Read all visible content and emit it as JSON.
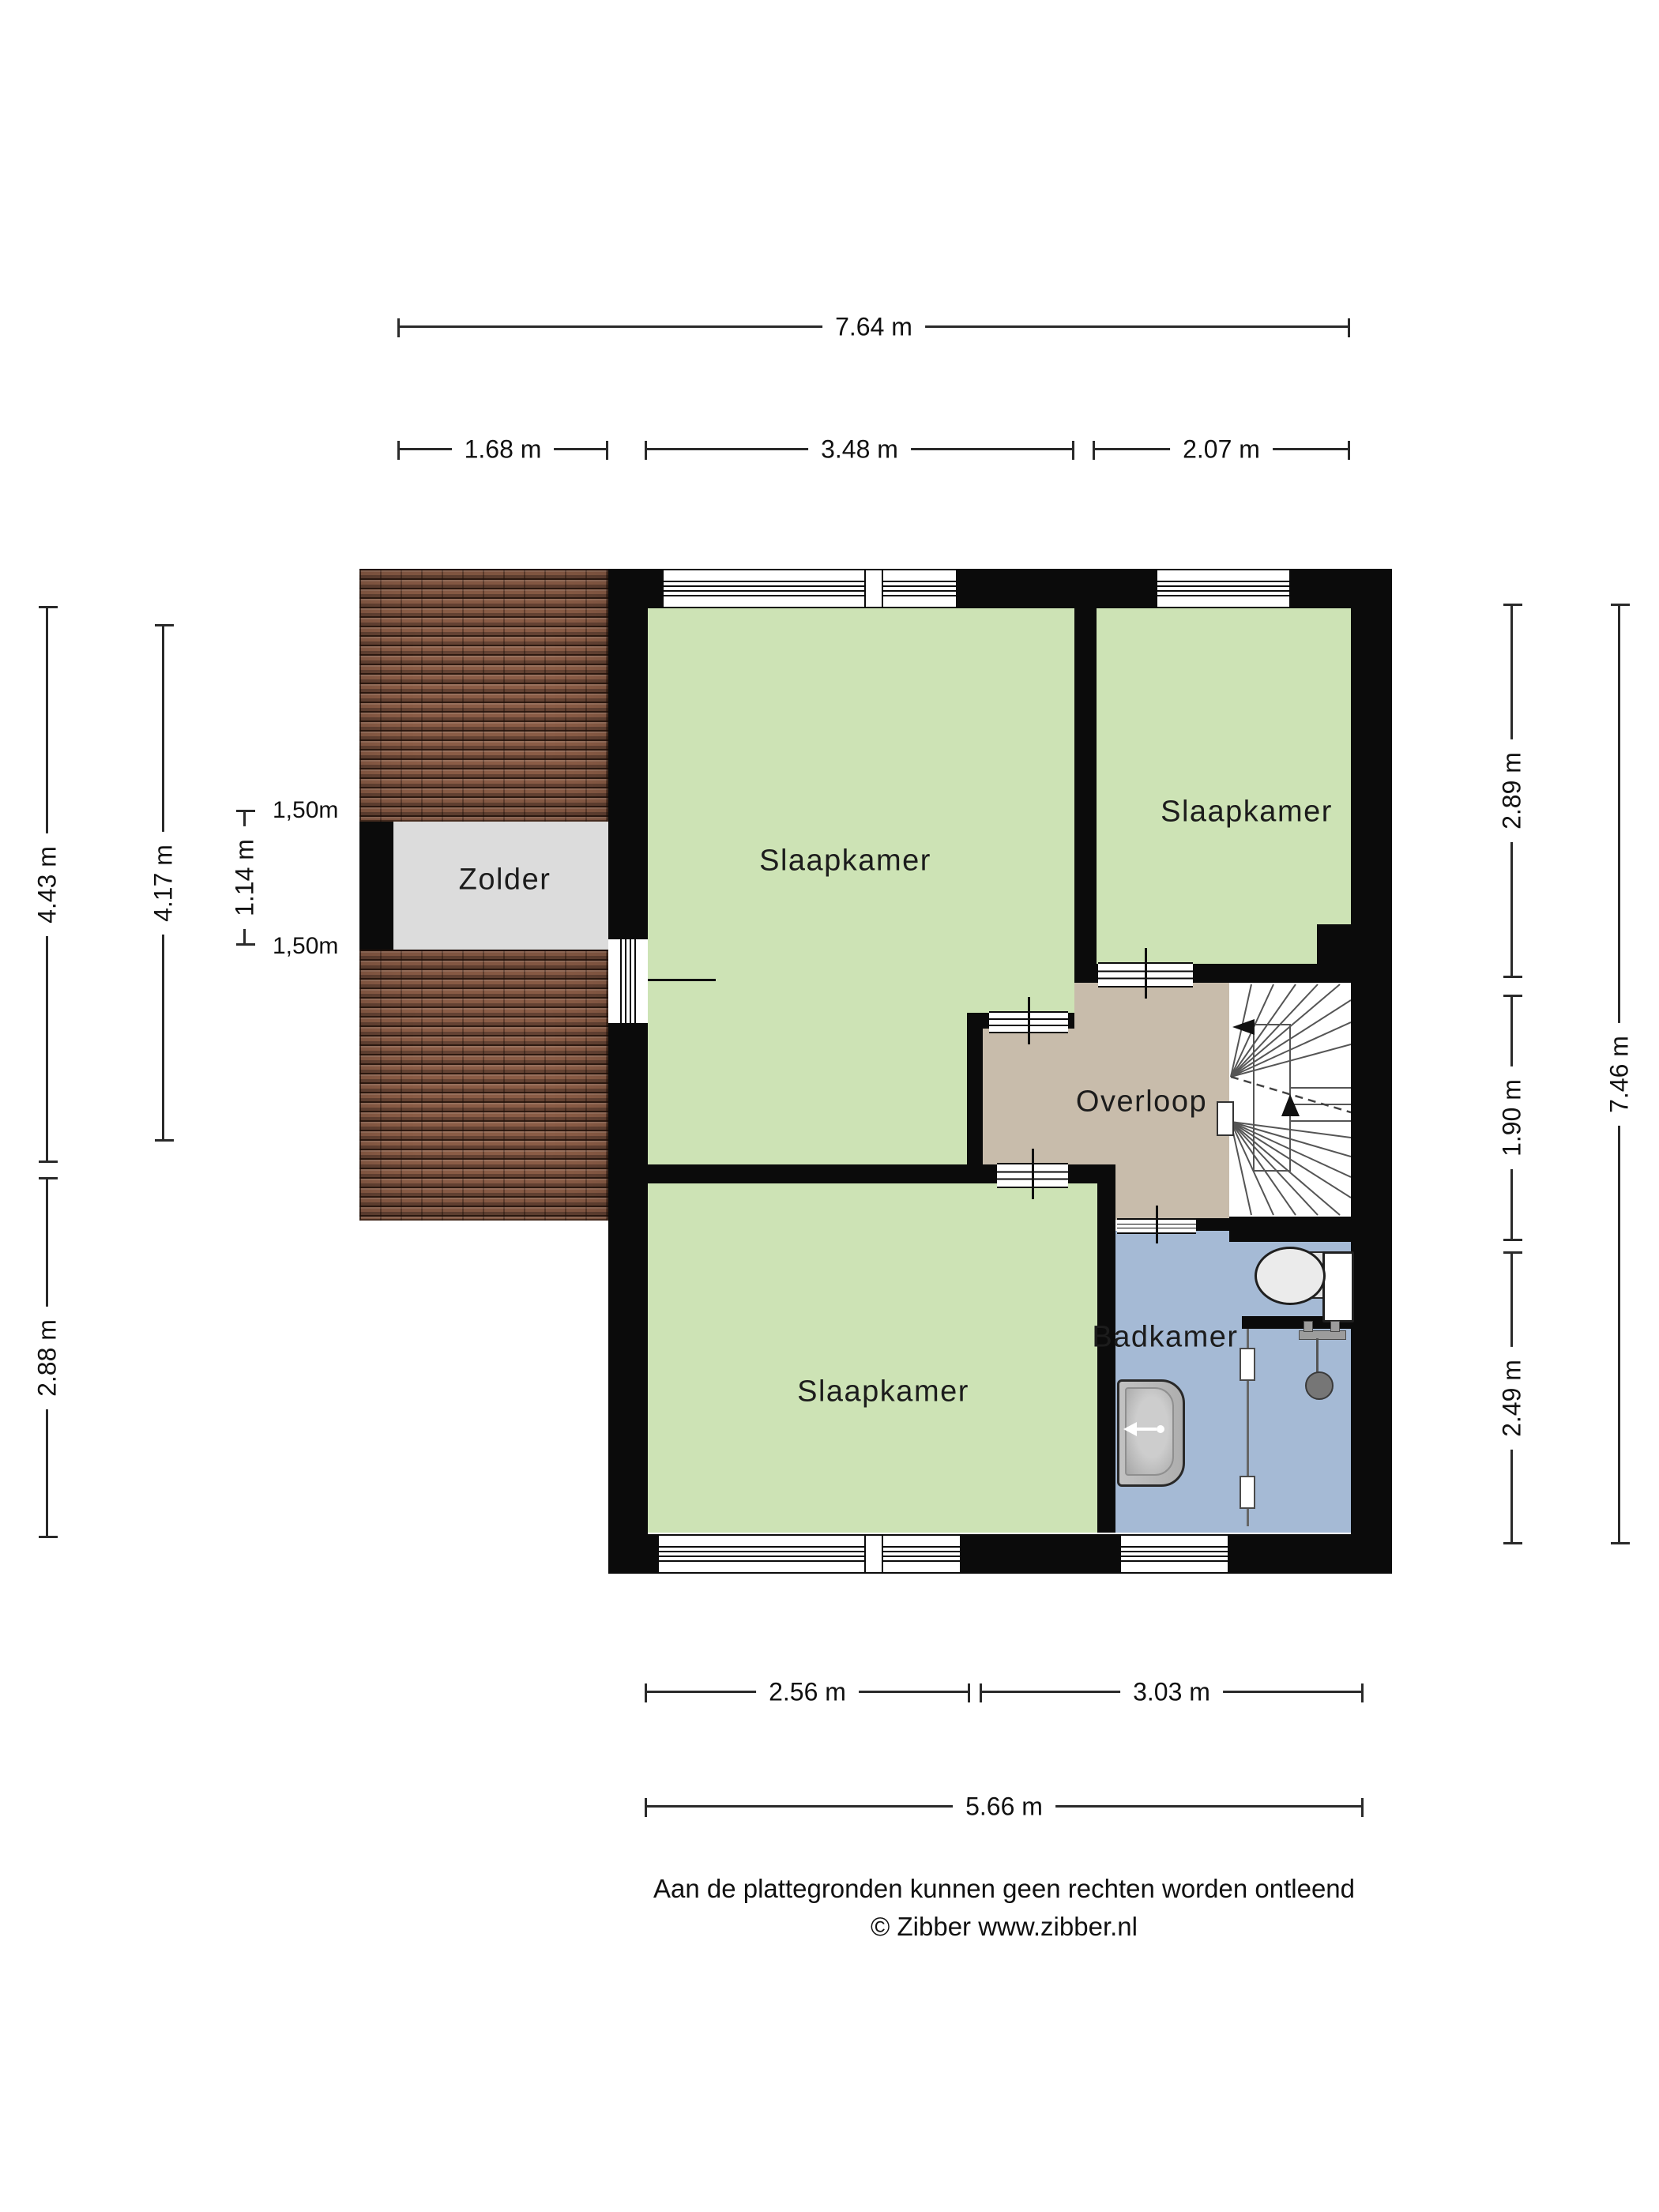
{
  "page": {
    "background_color": "#ffffff"
  },
  "floorplan": {
    "colors": {
      "wall": "#0b0b0b",
      "bedroom_green": "#cde3b5",
      "landing_tan": "#c8bcab",
      "bathroom_blue": "#a5bad5",
      "attic_gray": "#dcdcdc",
      "roof_brown": "#8a5c46"
    },
    "rooms": [
      {
        "id": "zolder",
        "label": "Zolder"
      },
      {
        "id": "slaapkamer-groot",
        "label": "Slaapkamer"
      },
      {
        "id": "slaapkamer-rechts",
        "label": "Slaapkamer"
      },
      {
        "id": "slaapkamer-onder",
        "label": "Slaapkamer"
      },
      {
        "id": "overloop",
        "label": "Overloop"
      },
      {
        "id": "badkamer",
        "label": "Badkamer"
      }
    ]
  },
  "dimensions": {
    "top": [
      {
        "label": "7.64 m"
      },
      {
        "label": "1.68 m"
      },
      {
        "label": "3.48 m"
      },
      {
        "label": "2.07 m"
      }
    ],
    "left": [
      {
        "label": "4.43 m"
      },
      {
        "label": "4.17 m"
      },
      {
        "label": "1.14 m"
      },
      {
        "label": "2.88 m"
      }
    ],
    "knee_wall": [
      {
        "label": "1,50m"
      },
      {
        "label": "1,50m"
      }
    ],
    "right": [
      {
        "label": "2.89 m"
      },
      {
        "label": "1.90 m"
      },
      {
        "label": "2.49 m"
      },
      {
        "label": "7.46 m"
      }
    ],
    "bottom": [
      {
        "label": "2.56 m"
      },
      {
        "label": "3.03 m"
      },
      {
        "label": "5.66 m"
      }
    ]
  },
  "footer": {
    "line1": "Aan de plattegronden kunnen geen rechten worden ontleend",
    "line2": "© Zibber www.zibber.nl"
  }
}
